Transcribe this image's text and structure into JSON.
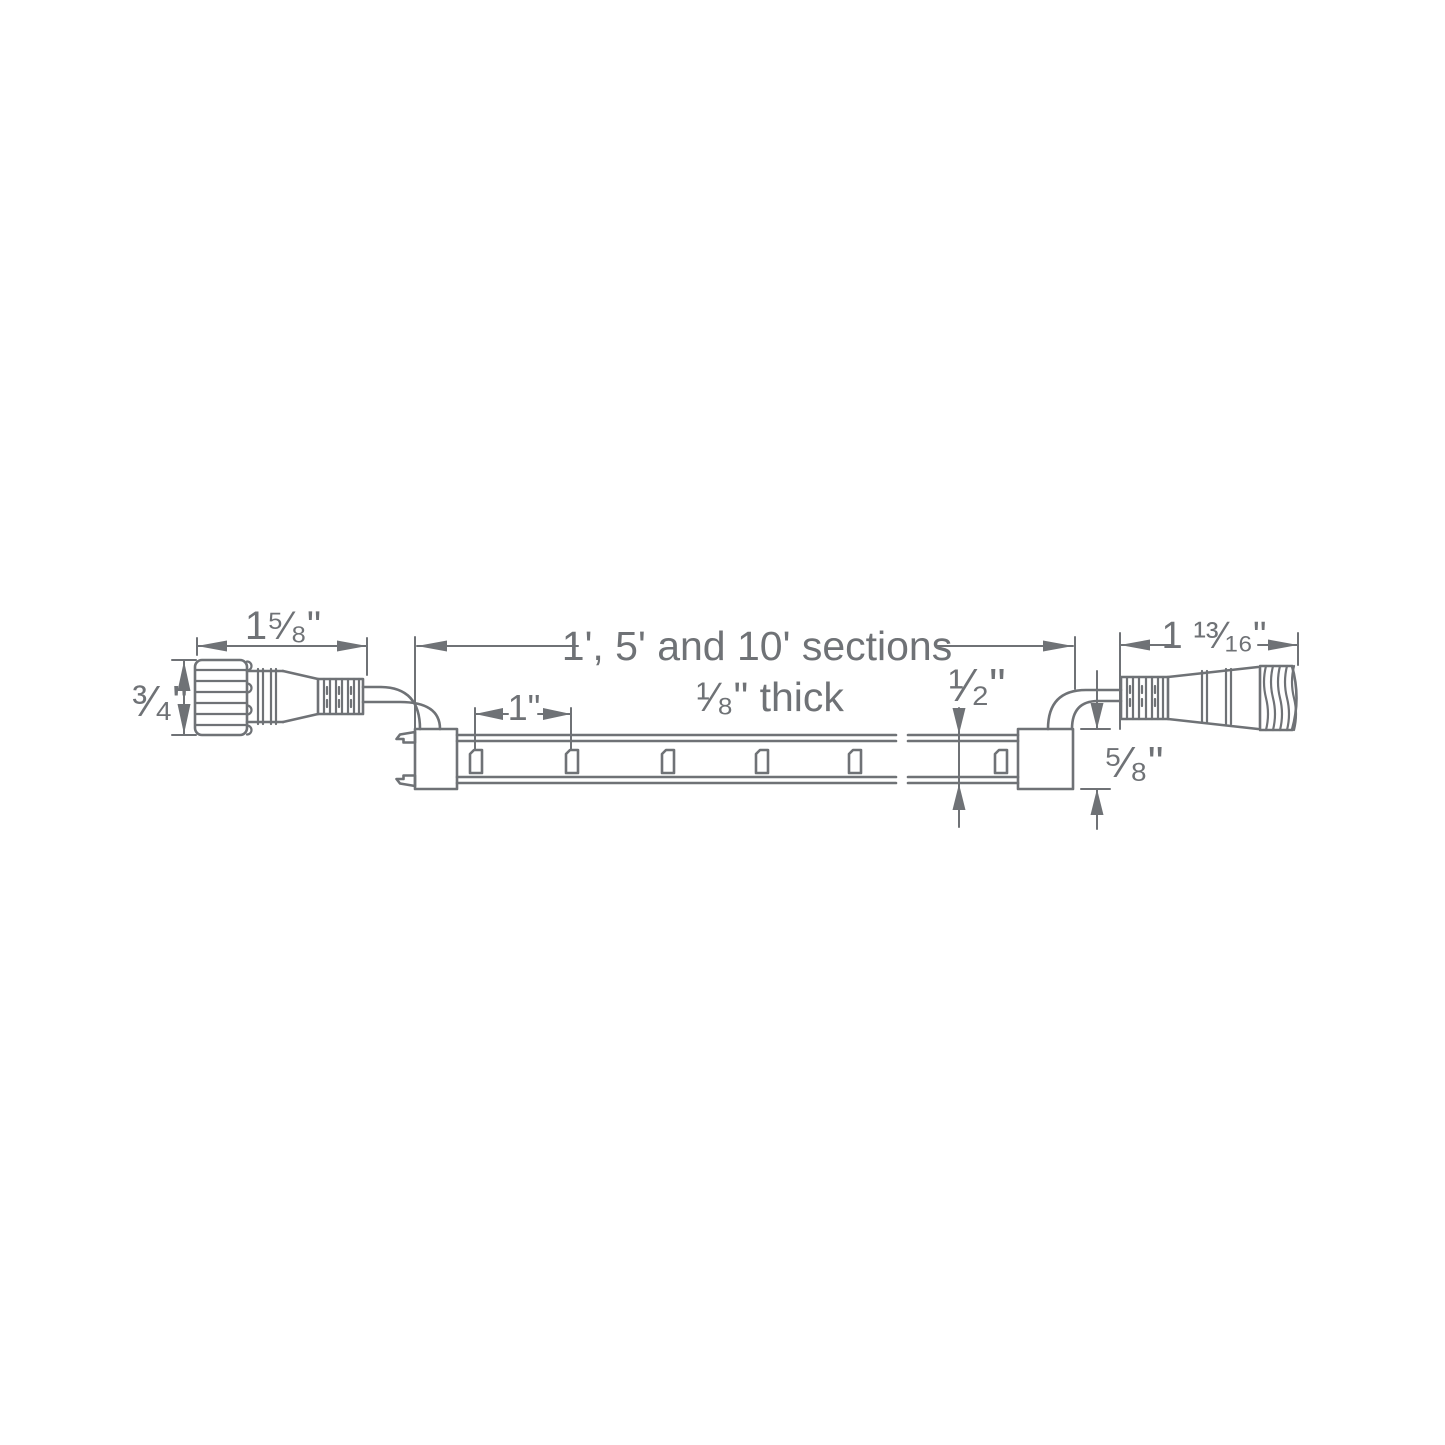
{
  "colors": {
    "line": "#6f7276",
    "background": "#ffffff"
  },
  "labels": {
    "left_connector_length": "1⁵⁄₈\"",
    "left_connector_diameter": "³⁄₄\"",
    "sections": "1', 5' and 10' sections",
    "thickness": "¹⁄₈\" thick",
    "led_spacing": "1\"",
    "strip_width": "¹⁄₂\"",
    "end_cap_width": "⁵⁄₈\"",
    "right_connector_length": "1 ¹³⁄₁₆\""
  }
}
